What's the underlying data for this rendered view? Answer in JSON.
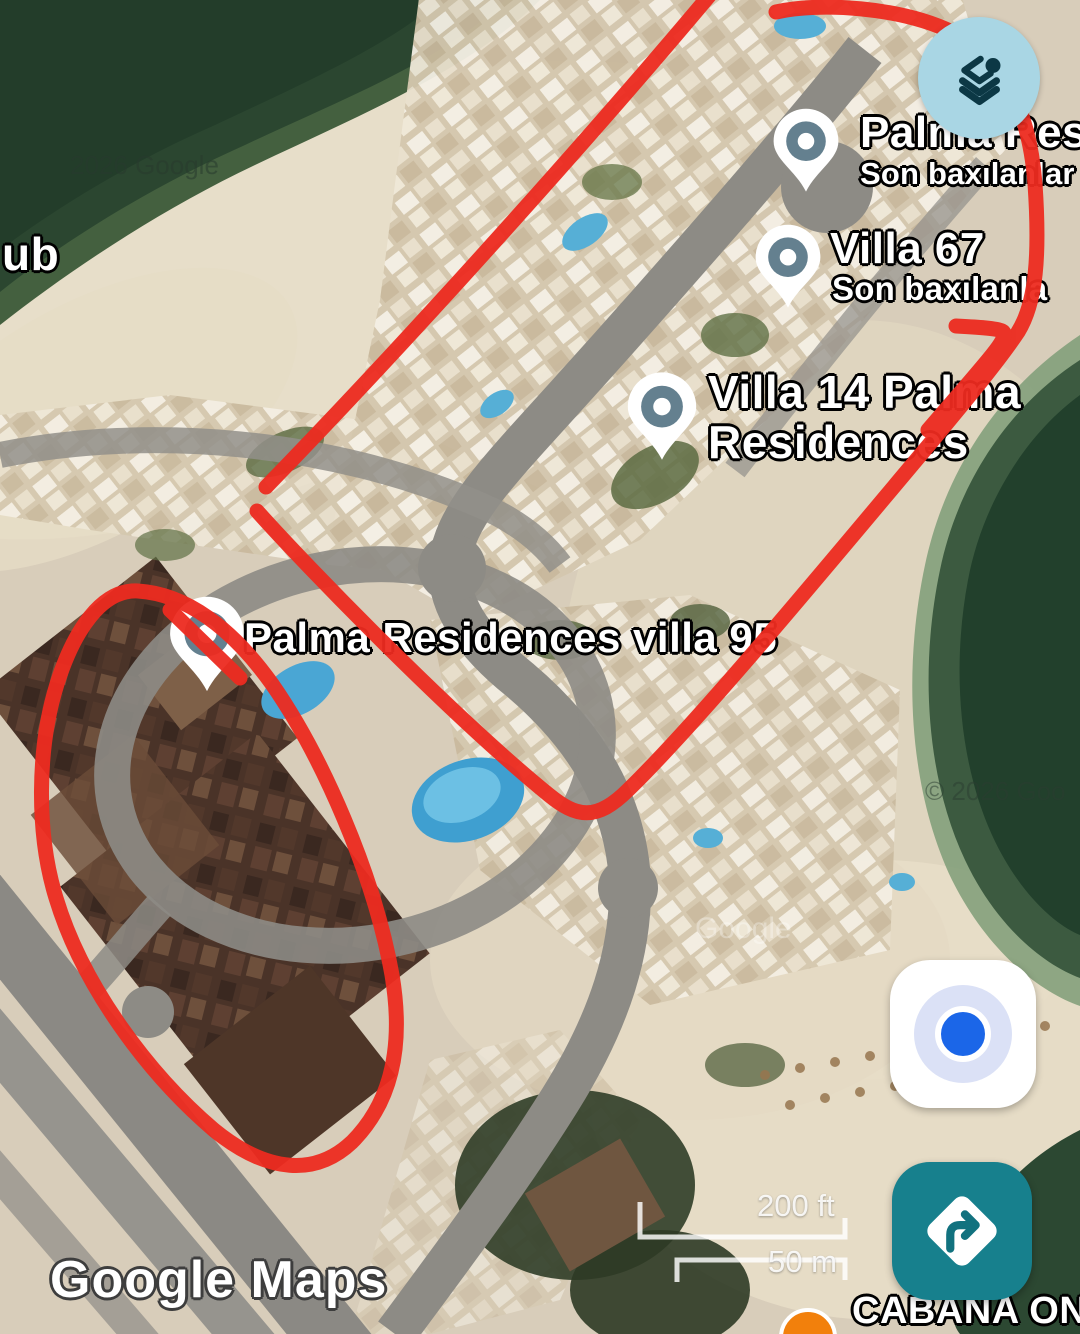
{
  "app": {
    "logo": "Google Maps"
  },
  "attribution": {
    "left": "2026 Google",
    "right": "© 2026 Goo",
    "center": "Google"
  },
  "edge_label": "ub",
  "pins": [
    {
      "id": "palma-residences",
      "title": "Palma Resid",
      "subtitle": "Son baxılanlar"
    },
    {
      "id": "villa-67",
      "title": "Villa 67",
      "subtitle": "Son baxılanla"
    },
    {
      "id": "villa-14",
      "title_line1": "Villa 14 Palma",
      "title_line2": "Residences"
    },
    {
      "id": "villa-95",
      "title": "Palma Residences villa 95"
    }
  ],
  "poi_bottom": {
    "label": "CABANA ON"
  },
  "scale": {
    "imperial": "200 ft",
    "metric": "50 m"
  },
  "controls": {
    "layers": "layers",
    "my_location": "my-location",
    "directions": "directions"
  },
  "colors": {
    "annotation_red": "#ED2B20",
    "layers_button_bg": "#A9D6E4",
    "layers_icon": "#0C3845",
    "directions_teal": "#17808D",
    "location_blue": "#1B66E8",
    "pin_inner": "#64808F",
    "poi_orange": "#F2800C"
  }
}
